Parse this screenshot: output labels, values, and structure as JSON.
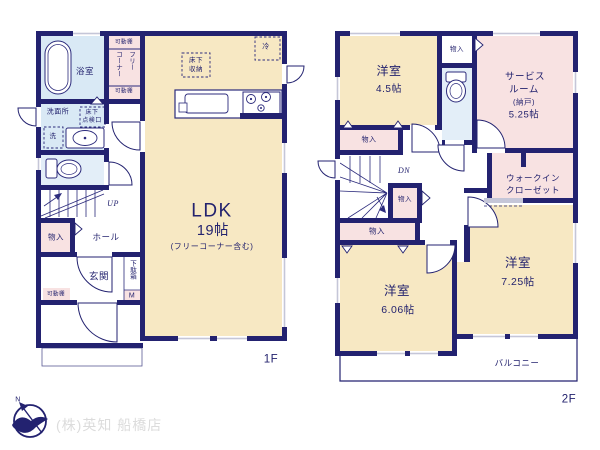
{
  "floor1": {
    "bathroom": "浴室",
    "shelf_top": "可動棚",
    "free_corner_col1": "フリー",
    "free_corner_col2": "コーナー",
    "shelf_bottom": "可動棚",
    "washroom": "洗面所",
    "underfloor_access_l1": "床下",
    "underfloor_access_l2": "点検口",
    "washer": "洗",
    "underfloor_storage_l1": "床下",
    "underfloor_storage_l2": "収納",
    "fridge": "冷",
    "ldk_name": "LDK",
    "ldk_size": "19帖",
    "ldk_note": "(フリーコーナー含む)",
    "stairs_up": "UP",
    "storage": "物入",
    "hall": "ホール",
    "entrance": "玄関",
    "shoe_box": "下駄箱",
    "shoe_box_m": "M",
    "entrance_shelf": "可動棚",
    "floor_label": "1F"
  },
  "floor2": {
    "bedroom1": "洋室",
    "bedroom1_size": "4.5帖",
    "bedroom1_closet": "物入",
    "hall_closet": "物入",
    "service_room_l1": "サービス",
    "service_room_l2": "ルーム",
    "service_room_l3": "(納戸)",
    "service_room_size": "5.25帖",
    "stairs_down": "DN",
    "stair_closet": "物入",
    "bedroom2_closet": "物入",
    "wic_l1": "ウォークイン",
    "wic_l2": "クローゼット",
    "bedroom2": "洋室",
    "bedroom2_size": "6.06帖",
    "bedroom3": "洋室",
    "bedroom3_size": "7.25帖",
    "balcony": "バルコニー",
    "floor_label": "2F"
  },
  "footer": {
    "company": "(株)英知 船橋店",
    "compass_north": "N"
  },
  "colors": {
    "wall": "#232270",
    "room_tatami": "#f7e8c3",
    "room_pink": "#f8e2e2",
    "room_bath": "#d9e9f5",
    "room_toilet": "#e3eef8",
    "window": "#c5c6d8",
    "text": "#23226e",
    "company_text": "#dcdcdc"
  }
}
